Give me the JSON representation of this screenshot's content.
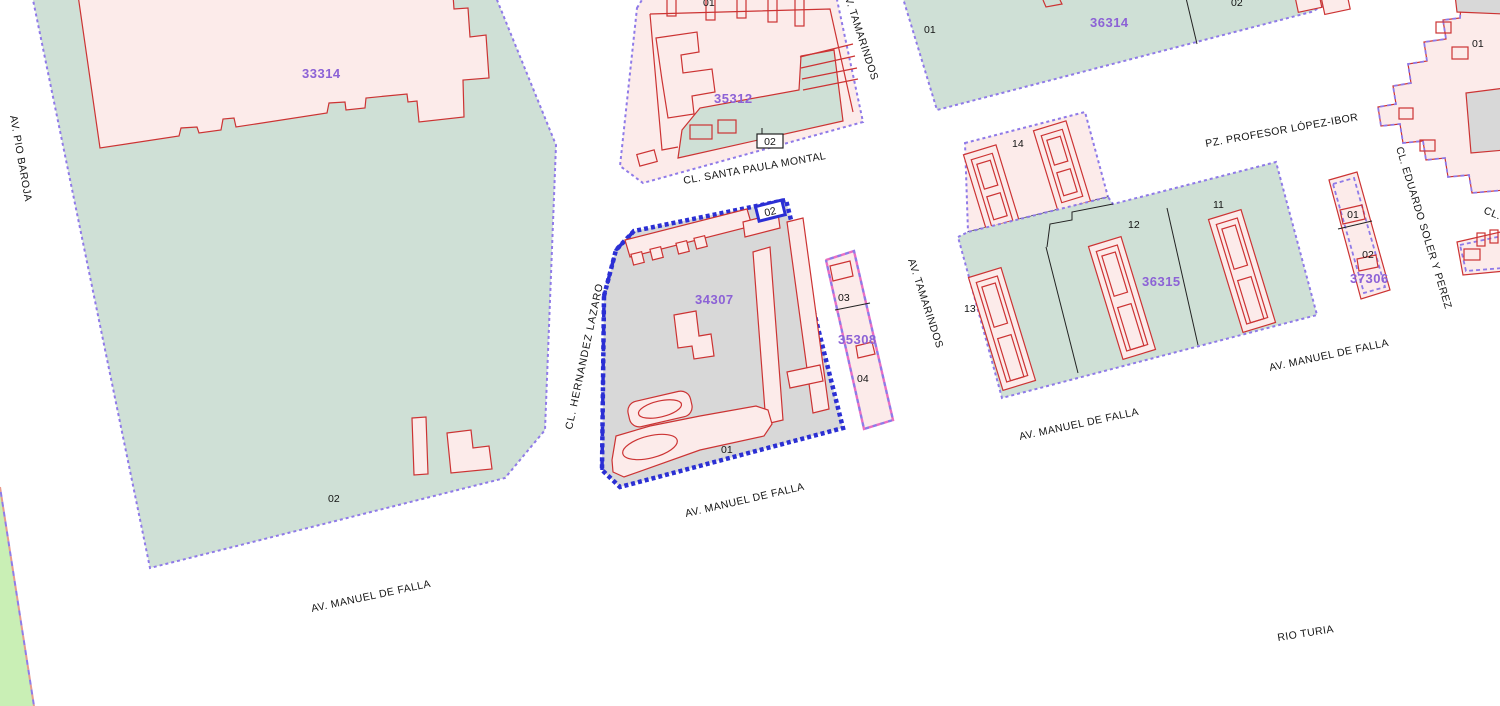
{
  "app": {
    "name": "Cadastral parcel map",
    "view": "urban cadastre plan"
  },
  "colors": {
    "green": "#cfe0d6",
    "zonegreen": "#c9efb5",
    "pink": "#fcebea",
    "gray": "#d8d8d8",
    "red": "#cc3333",
    "purple": "#8f7ae8",
    "blue": "#2b2fd4",
    "magenta": "#ea6fc4",
    "labelpurple": "#8c62d6",
    "ink": "#141414"
  },
  "parcels": {
    "p33314": {
      "id": "33314",
      "sub": {
        "s02": "02"
      }
    },
    "p35312": {
      "id": "35312",
      "sub": {
        "s01": "01",
        "s02": "02"
      }
    },
    "p34307": {
      "id": "34307",
      "selected": true,
      "sub": {
        "s01": "01",
        "s02": "02"
      }
    },
    "p35308": {
      "id": "35308",
      "sub": {
        "s03": "03",
        "s04": "04"
      }
    },
    "p36314": {
      "id": "36314",
      "sub": {
        "s01": "01",
        "s02": "02"
      }
    },
    "p14": {
      "sub": {
        "s14": "14"
      }
    },
    "p36315": {
      "id": "36315",
      "sub": {
        "s11": "11",
        "s12": "12",
        "s13": "13"
      }
    },
    "p37306": {
      "id": "37306",
      "sub": {
        "s01": "01",
        "s02": "02"
      }
    },
    "pNE": {
      "sub": {
        "s01": "01"
      }
    }
  },
  "streets": {
    "pio_baroja": "AV. PIO BAROJA",
    "hernandez_lazaro": "CL. HERNANDEZ LAZARO",
    "santa_paula_montal": "CL. SANTA PAULA MONTAL",
    "tamarindos": "AV. TAMARINDOS",
    "manuel_de_falla": "AV. MANUEL DE FALLA",
    "profesor_lopez_ibor": "PZ. PROFESOR LÓPEZ-IBOR",
    "eduardo_soler": "CL. EDUARDO SOLER Y PEREZ",
    "rio_turia": "RIO TURIA",
    "cl_partial": "CL."
  }
}
